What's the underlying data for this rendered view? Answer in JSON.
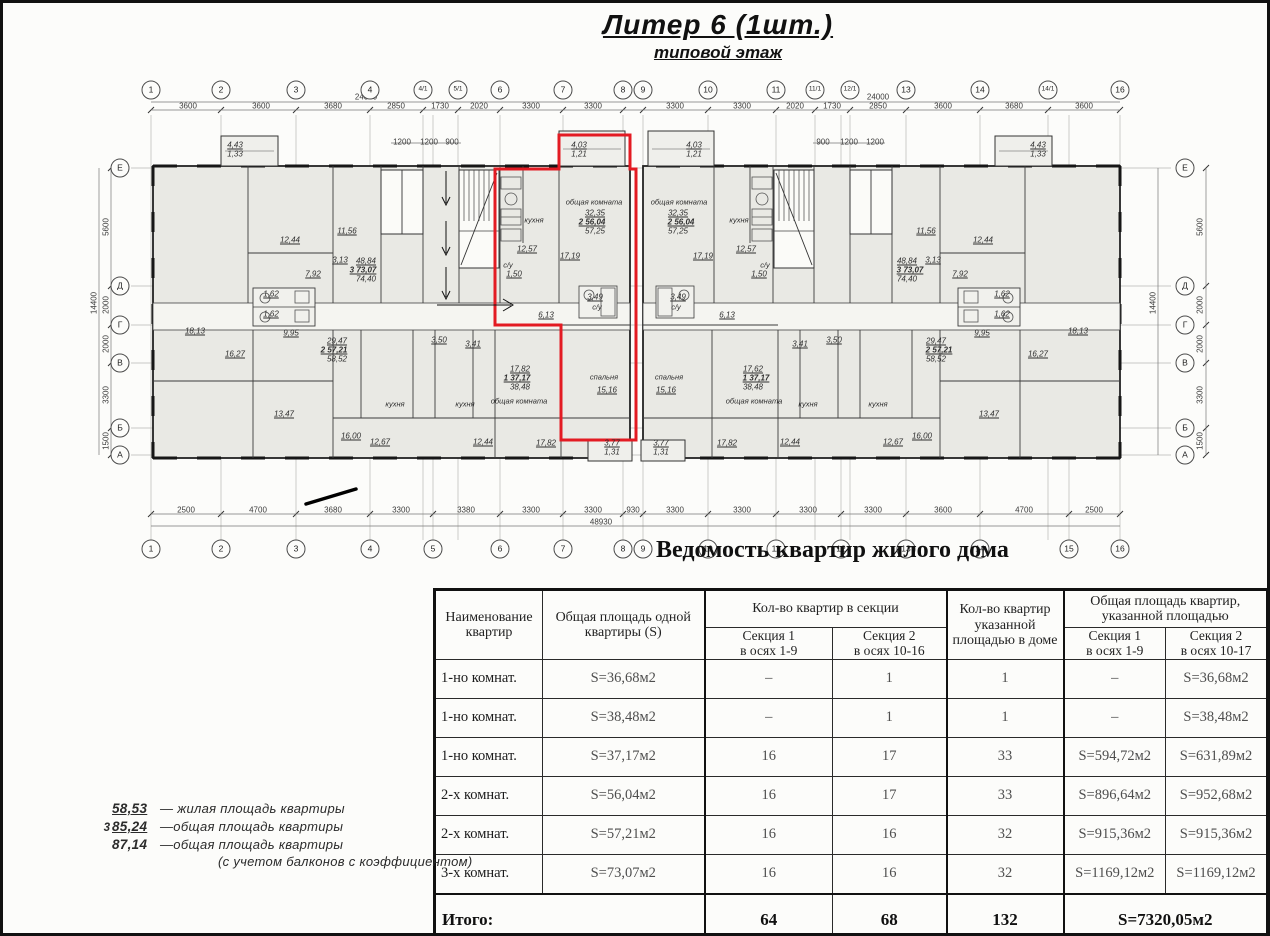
{
  "title": "Литер 6 (1шт.)",
  "subtitle": "типовой этаж",
  "caption": "Ведомость квартир жилого дома",
  "colors": {
    "red_outline": "#e31b23",
    "paper": "#fcfcfa",
    "room_fill": "#e9e9e4"
  },
  "plan": {
    "axes_top": [
      {
        "label": "1",
        "x": 148
      },
      {
        "label": "2",
        "x": 218
      },
      {
        "label": "3",
        "x": 293
      },
      {
        "label": "4",
        "x": 367
      },
      {
        "label": "4/1",
        "x": 420
      },
      {
        "label": "5/1",
        "x": 455
      },
      {
        "label": "6",
        "x": 497
      },
      {
        "label": "7",
        "x": 560
      },
      {
        "label": "8",
        "x": 620
      },
      {
        "label": "9",
        "x": 640
      },
      {
        "label": "10",
        "x": 705
      },
      {
        "label": "11",
        "x": 773
      },
      {
        "label": "11/1",
        "x": 812
      },
      {
        "label": "12/1",
        "x": 847
      },
      {
        "label": "13",
        "x": 903
      },
      {
        "label": "14",
        "x": 977
      },
      {
        "label": "14/1",
        "x": 1045
      },
      {
        "label": "16",
        "x": 1117
      }
    ],
    "axes_bottom": [
      {
        "label": "1",
        "x": 148
      },
      {
        "label": "2",
        "x": 218
      },
      {
        "label": "3",
        "x": 293
      },
      {
        "label": "4",
        "x": 367
      },
      {
        "label": "5",
        "x": 430
      },
      {
        "label": "6",
        "x": 497
      },
      {
        "label": "7",
        "x": 560
      },
      {
        "label": "8",
        "x": 620
      },
      {
        "label": "9",
        "x": 640
      },
      {
        "label": "10",
        "x": 705
      },
      {
        "label": "11",
        "x": 773
      },
      {
        "label": "12",
        "x": 838
      },
      {
        "label": "13",
        "x": 903
      },
      {
        "label": "14",
        "x": 977
      },
      {
        "label": "15",
        "x": 1066
      },
      {
        "label": "16",
        "x": 1117
      }
    ],
    "row_axes": [
      {
        "label": "Е",
        "y": 165
      },
      {
        "label": "Д",
        "y": 283
      },
      {
        "label": "Г",
        "y": 322
      },
      {
        "label": "В",
        "y": 360
      },
      {
        "label": "Б",
        "y": 425
      },
      {
        "label": "А",
        "y": 452
      }
    ],
    "dims": [
      {
        "t": "24000",
        "x": 363,
        "y": 94
      },
      {
        "t": "24000",
        "x": 875,
        "y": 94
      },
      {
        "t": "3600",
        "x": 185,
        "y": 103
      },
      {
        "t": "3600",
        "x": 258,
        "y": 103
      },
      {
        "t": "3680",
        "x": 330,
        "y": 103
      },
      {
        "t": "2850",
        "x": 393,
        "y": 103
      },
      {
        "t": "1730",
        "x": 437,
        "y": 103
      },
      {
        "t": "2020",
        "x": 476,
        "y": 103
      },
      {
        "t": "3300",
        "x": 528,
        "y": 103
      },
      {
        "t": "3300",
        "x": 590,
        "y": 103
      },
      {
        "t": "3300",
        "x": 672,
        "y": 103
      },
      {
        "t": "3300",
        "x": 739,
        "y": 103
      },
      {
        "t": "2020",
        "x": 792,
        "y": 103
      },
      {
        "t": "1730",
        "x": 829,
        "y": 103
      },
      {
        "t": "2850",
        "x": 875,
        "y": 103
      },
      {
        "t": "3600",
        "x": 940,
        "y": 103
      },
      {
        "t": "3680",
        "x": 1011,
        "y": 103
      },
      {
        "t": "3600",
        "x": 1081,
        "y": 103
      },
      {
        "t": "1200",
        "x": 399,
        "y": 139
      },
      {
        "t": "1200",
        "x": 426,
        "y": 139
      },
      {
        "t": "900",
        "x": 449,
        "y": 139
      },
      {
        "t": "900",
        "x": 820,
        "y": 139
      },
      {
        "t": "1200",
        "x": 846,
        "y": 139
      },
      {
        "t": "1200",
        "x": 872,
        "y": 139
      },
      {
        "t": "2500",
        "x": 183,
        "y": 507
      },
      {
        "t": "4700",
        "x": 255,
        "y": 507
      },
      {
        "t": "3680",
        "x": 330,
        "y": 507
      },
      {
        "t": "3300",
        "x": 398,
        "y": 507
      },
      {
        "t": "3380",
        "x": 463,
        "y": 507
      },
      {
        "t": "3300",
        "x": 528,
        "y": 507
      },
      {
        "t": "3300",
        "x": 590,
        "y": 507
      },
      {
        "t": "930",
        "x": 630,
        "y": 507
      },
      {
        "t": "3300",
        "x": 672,
        "y": 507
      },
      {
        "t": "3300",
        "x": 739,
        "y": 507
      },
      {
        "t": "3300",
        "x": 805,
        "y": 507
      },
      {
        "t": "3300",
        "x": 870,
        "y": 507
      },
      {
        "t": "3600",
        "x": 940,
        "y": 507
      },
      {
        "t": "4700",
        "x": 1021,
        "y": 507
      },
      {
        "t": "2500",
        "x": 1091,
        "y": 507
      },
      {
        "t": "48930",
        "x": 598,
        "y": 519
      },
      {
        "t": "5600",
        "x": 103,
        "y": 224,
        "v": true
      },
      {
        "t": "2000",
        "x": 103,
        "y": 302,
        "v": true
      },
      {
        "t": "2000",
        "x": 103,
        "y": 341,
        "v": true
      },
      {
        "t": "3300",
        "x": 103,
        "y": 392,
        "v": true
      },
      {
        "t": "1500",
        "x": 103,
        "y": 438,
        "v": true
      },
      {
        "t": "14400",
        "x": 91,
        "y": 300,
        "v": true
      },
      {
        "t": "5600",
        "x": 1197,
        "y": 224,
        "v": true
      },
      {
        "t": "2000",
        "x": 1197,
        "y": 302,
        "v": true
      },
      {
        "t": "2000",
        "x": 1197,
        "y": 341,
        "v": true
      },
      {
        "t": "3300",
        "x": 1197,
        "y": 392,
        "v": true
      },
      {
        "t": "1500",
        "x": 1197,
        "y": 438,
        "v": true
      },
      {
        "t": "14400",
        "x": 1150,
        "y": 300,
        "v": true
      }
    ],
    "labels": [
      {
        "t": "4,43",
        "x": 232,
        "y": 142,
        "c": "u"
      },
      {
        "t": "1,33",
        "x": 232,
        "y": 151
      },
      {
        "t": "18,13",
        "x": 192,
        "y": 328,
        "c": "u"
      },
      {
        "t": "12,44",
        "x": 287,
        "y": 237,
        "c": "u"
      },
      {
        "t": "48,84",
        "x": 363,
        "y": 258,
        "c": "u"
      },
      {
        "t": "3 73,07",
        "x": 360,
        "y": 267,
        "c": "u b"
      },
      {
        "t": "74,40",
        "x": 363,
        "y": 276
      },
      {
        "t": "11,56",
        "x": 344,
        "y": 228,
        "c": "u"
      },
      {
        "t": "3,13",
        "x": 337,
        "y": 257,
        "c": "u"
      },
      {
        "t": "7,92",
        "x": 310,
        "y": 271,
        "c": "u"
      },
      {
        "t": "1,62",
        "x": 268,
        "y": 291,
        "c": "u"
      },
      {
        "t": "1,62",
        "x": 268,
        "y": 311,
        "c": "u"
      },
      {
        "t": "9,95",
        "x": 288,
        "y": 330,
        "c": "u"
      },
      {
        "t": "29,47",
        "x": 334,
        "y": 338,
        "c": "u"
      },
      {
        "t": "2 57,21",
        "x": 331,
        "y": 347,
        "c": "u b"
      },
      {
        "t": "58,52",
        "x": 334,
        "y": 356
      },
      {
        "t": "16,27",
        "x": 232,
        "y": 351,
        "c": "u"
      },
      {
        "t": "13,47",
        "x": 281,
        "y": 411,
        "c": "u"
      },
      {
        "t": "16,00",
        "x": 348,
        "y": 433,
        "c": "u"
      },
      {
        "t": "12,67",
        "x": 377,
        "y": 439,
        "c": "u"
      },
      {
        "t": "кухня",
        "x": 392,
        "y": 401,
        "c": "nm"
      },
      {
        "t": "кухня",
        "x": 462,
        "y": 401,
        "c": "nm"
      },
      {
        "t": "12,44",
        "x": 480,
        "y": 439,
        "c": "u"
      },
      {
        "t": "общая комната",
        "x": 516,
        "y": 398,
        "c": "nm"
      },
      {
        "t": "17,82",
        "x": 517,
        "y": 366,
        "c": "u"
      },
      {
        "t": "1 37,17",
        "x": 514,
        "y": 375,
        "c": "u b"
      },
      {
        "t": "38,48",
        "x": 517,
        "y": 384
      },
      {
        "t": "17,82",
        "x": 543,
        "y": 440,
        "c": "u"
      },
      {
        "t": "3,50",
        "x": 436,
        "y": 337,
        "c": "u"
      },
      {
        "t": "3,41",
        "x": 470,
        "y": 341,
        "c": "u"
      },
      {
        "t": "кухня",
        "x": 531,
        "y": 217,
        "c": "nm"
      },
      {
        "t": "12,57",
        "x": 524,
        "y": 246,
        "c": "u"
      },
      {
        "t": "общая комната",
        "x": 591,
        "y": 199,
        "c": "nm"
      },
      {
        "t": "32,35",
        "x": 592,
        "y": 210,
        "c": "u"
      },
      {
        "t": "2 56,04",
        "x": 589,
        "y": 219,
        "c": "u b"
      },
      {
        "t": "57,25",
        "x": 592,
        "y": 228
      },
      {
        "t": "17,19",
        "x": 567,
        "y": 253,
        "c": "u"
      },
      {
        "t": "с/у",
        "x": 505,
        "y": 262,
        "c": "nm"
      },
      {
        "t": "1,50",
        "x": 511,
        "y": 271,
        "c": "u"
      },
      {
        "t": "4,03",
        "x": 576,
        "y": 142,
        "c": "u"
      },
      {
        "t": "1,21",
        "x": 576,
        "y": 151
      },
      {
        "t": "6,13",
        "x": 543,
        "y": 312,
        "c": "u"
      },
      {
        "t": "3,49",
        "x": 592,
        "y": 294,
        "c": "u"
      },
      {
        "t": "с/у",
        "x": 594,
        "y": 304,
        "c": "nm"
      },
      {
        "t": "спальня",
        "x": 601,
        "y": 374,
        "c": "nm"
      },
      {
        "t": "15,16",
        "x": 604,
        "y": 387,
        "c": "u"
      },
      {
        "t": "3,77",
        "x": 609,
        "y": 440,
        "c": "u"
      },
      {
        "t": "1,31",
        "x": 609,
        "y": 449
      },
      {
        "t": "4,03",
        "x": 691,
        "y": 142,
        "c": "u"
      },
      {
        "t": "1,21",
        "x": 691,
        "y": 151
      },
      {
        "t": "общая комната",
        "x": 676,
        "y": 199,
        "c": "nm"
      },
      {
        "t": "32,35",
        "x": 675,
        "y": 210,
        "c": "u"
      },
      {
        "t": "2 56,04",
        "x": 678,
        "y": 219,
        "c": "u b"
      },
      {
        "t": "57,25",
        "x": 675,
        "y": 228
      },
      {
        "t": "кухня",
        "x": 736,
        "y": 217,
        "c": "nm"
      },
      {
        "t": "12,57",
        "x": 743,
        "y": 246,
        "c": "u"
      },
      {
        "t": "17,19",
        "x": 700,
        "y": 253,
        "c": "u"
      },
      {
        "t": "с/у",
        "x": 762,
        "y": 262,
        "c": "nm"
      },
      {
        "t": "1,50",
        "x": 756,
        "y": 271,
        "c": "u"
      },
      {
        "t": "6,13",
        "x": 724,
        "y": 312,
        "c": "u"
      },
      {
        "t": "3,49",
        "x": 675,
        "y": 294,
        "c": "u"
      },
      {
        "t": "с/у",
        "x": 673,
        "y": 304,
        "c": "nm"
      },
      {
        "t": "спальня",
        "x": 666,
        "y": 374,
        "c": "nm"
      },
      {
        "t": "15,16",
        "x": 663,
        "y": 387,
        "c": "u"
      },
      {
        "t": "3,77",
        "x": 658,
        "y": 440,
        "c": "u"
      },
      {
        "t": "1,31",
        "x": 658,
        "y": 449
      },
      {
        "t": "17,62",
        "x": 750,
        "y": 366,
        "c": "u"
      },
      {
        "t": "1 37,17",
        "x": 753,
        "y": 375,
        "c": "u b"
      },
      {
        "t": "38,48",
        "x": 750,
        "y": 384
      },
      {
        "t": "общая комната",
        "x": 751,
        "y": 398,
        "c": "nm"
      },
      {
        "t": "17,82",
        "x": 724,
        "y": 440,
        "c": "u"
      },
      {
        "t": "12,44",
        "x": 787,
        "y": 439,
        "c": "u"
      },
      {
        "t": "кухня",
        "x": 805,
        "y": 401,
        "c": "nm"
      },
      {
        "t": "кухня",
        "x": 875,
        "y": 401,
        "c": "nm"
      },
      {
        "t": "12,67",
        "x": 890,
        "y": 439,
        "c": "u"
      },
      {
        "t": "16,00",
        "x": 919,
        "y": 433,
        "c": "u"
      },
      {
        "t": "13,47",
        "x": 986,
        "y": 411,
        "c": "u"
      },
      {
        "t": "3,41",
        "x": 797,
        "y": 341,
        "c": "u"
      },
      {
        "t": "3,50",
        "x": 831,
        "y": 337,
        "c": "u"
      },
      {
        "t": "29,47",
        "x": 933,
        "y": 338,
        "c": "u"
      },
      {
        "t": "2 57,21",
        "x": 936,
        "y": 347,
        "c": "u b"
      },
      {
        "t": "58,52",
        "x": 933,
        "y": 356
      },
      {
        "t": "9,95",
        "x": 979,
        "y": 330,
        "c": "u"
      },
      {
        "t": "1,62",
        "x": 999,
        "y": 291,
        "c": "u"
      },
      {
        "t": "1,62",
        "x": 999,
        "y": 311,
        "c": "u"
      },
      {
        "t": "7,92",
        "x": 957,
        "y": 271,
        "c": "u"
      },
      {
        "t": "3,13",
        "x": 930,
        "y": 257,
        "c": "u"
      },
      {
        "t": "11,56",
        "x": 923,
        "y": 228,
        "c": "u"
      },
      {
        "t": "12,44",
        "x": 980,
        "y": 237,
        "c": "u"
      },
      {
        "t": "48,84",
        "x": 904,
        "y": 258,
        "c": "u"
      },
      {
        "t": "3 73,07",
        "x": 907,
        "y": 267,
        "c": "u b"
      },
      {
        "t": "74,40",
        "x": 904,
        "y": 276
      },
      {
        "t": "16,27",
        "x": 1035,
        "y": 351,
        "c": "u"
      },
      {
        "t": "18,13",
        "x": 1075,
        "y": 328,
        "c": "u"
      },
      {
        "t": "4,43",
        "x": 1035,
        "y": 142,
        "c": "u"
      },
      {
        "t": "1,33",
        "x": 1035,
        "y": 151
      }
    ]
  },
  "table": {
    "headers": {
      "name": "Наименование квартир",
      "area_one": "Общая площадь одной квартиры (S)",
      "count_section": "Кол-во квартир в секции",
      "count_house": "Кол-во квартир указанной площадью в доме",
      "area_total": "Общая площадь квартир, указанной площадью",
      "sub": [
        {
          "l1": "Секция 1",
          "l2": "в осях 1-9"
        },
        {
          "l1": "Секция 2",
          "l2": "в осях 10-16"
        },
        {
          "l1": "Секция 1",
          "l2": "в осях 1-9"
        },
        {
          "l1": "Секция 2",
          "l2": "в осях 10-17"
        }
      ]
    },
    "rows": [
      [
        "1-но комнат.",
        "S=36,68м2",
        "–",
        "1",
        "1",
        "–",
        "S=36,68м2"
      ],
      [
        "1-но комнат.",
        "S=38,48м2",
        "–",
        "1",
        "1",
        "–",
        "S=38,48м2"
      ],
      [
        "1-но комнат.",
        "S=37,17м2",
        "16",
        "17",
        "33",
        "S=594,72м2",
        "S=631,89м2"
      ],
      [
        "2-х комнат.",
        "S=56,04м2",
        "16",
        "17",
        "33",
        "S=896,64м2",
        "S=952,68м2"
      ],
      [
        "2-х комнат.",
        "S=57,21м2",
        "16",
        "16",
        "32",
        "S=915,36м2",
        "S=915,36м2"
      ],
      [
        "3-х комнат.",
        "S=73,07м2",
        "16",
        "16",
        "32",
        "S=1169,12м2",
        "S=1169,12м2"
      ]
    ],
    "total": {
      "label": "Итого:",
      "sec1": "64",
      "sec2": "68",
      "house": "132",
      "area": "S=7320,05м2"
    }
  },
  "legend": {
    "items": [
      {
        "pre": "",
        "num": "58,53",
        "u": true,
        "text": "— жилая площадь квартиры"
      },
      {
        "pre": "3",
        "num": "85,24",
        "u": true,
        "text": "—общая площадь квартиры"
      },
      {
        "pre": "",
        "num": "87,14",
        "u": false,
        "text": "—общая площадь квартиры"
      },
      {
        "pre": "",
        "num": "",
        "u": false,
        "text": "(с учетом балконов с коэффициентом)"
      }
    ]
  }
}
